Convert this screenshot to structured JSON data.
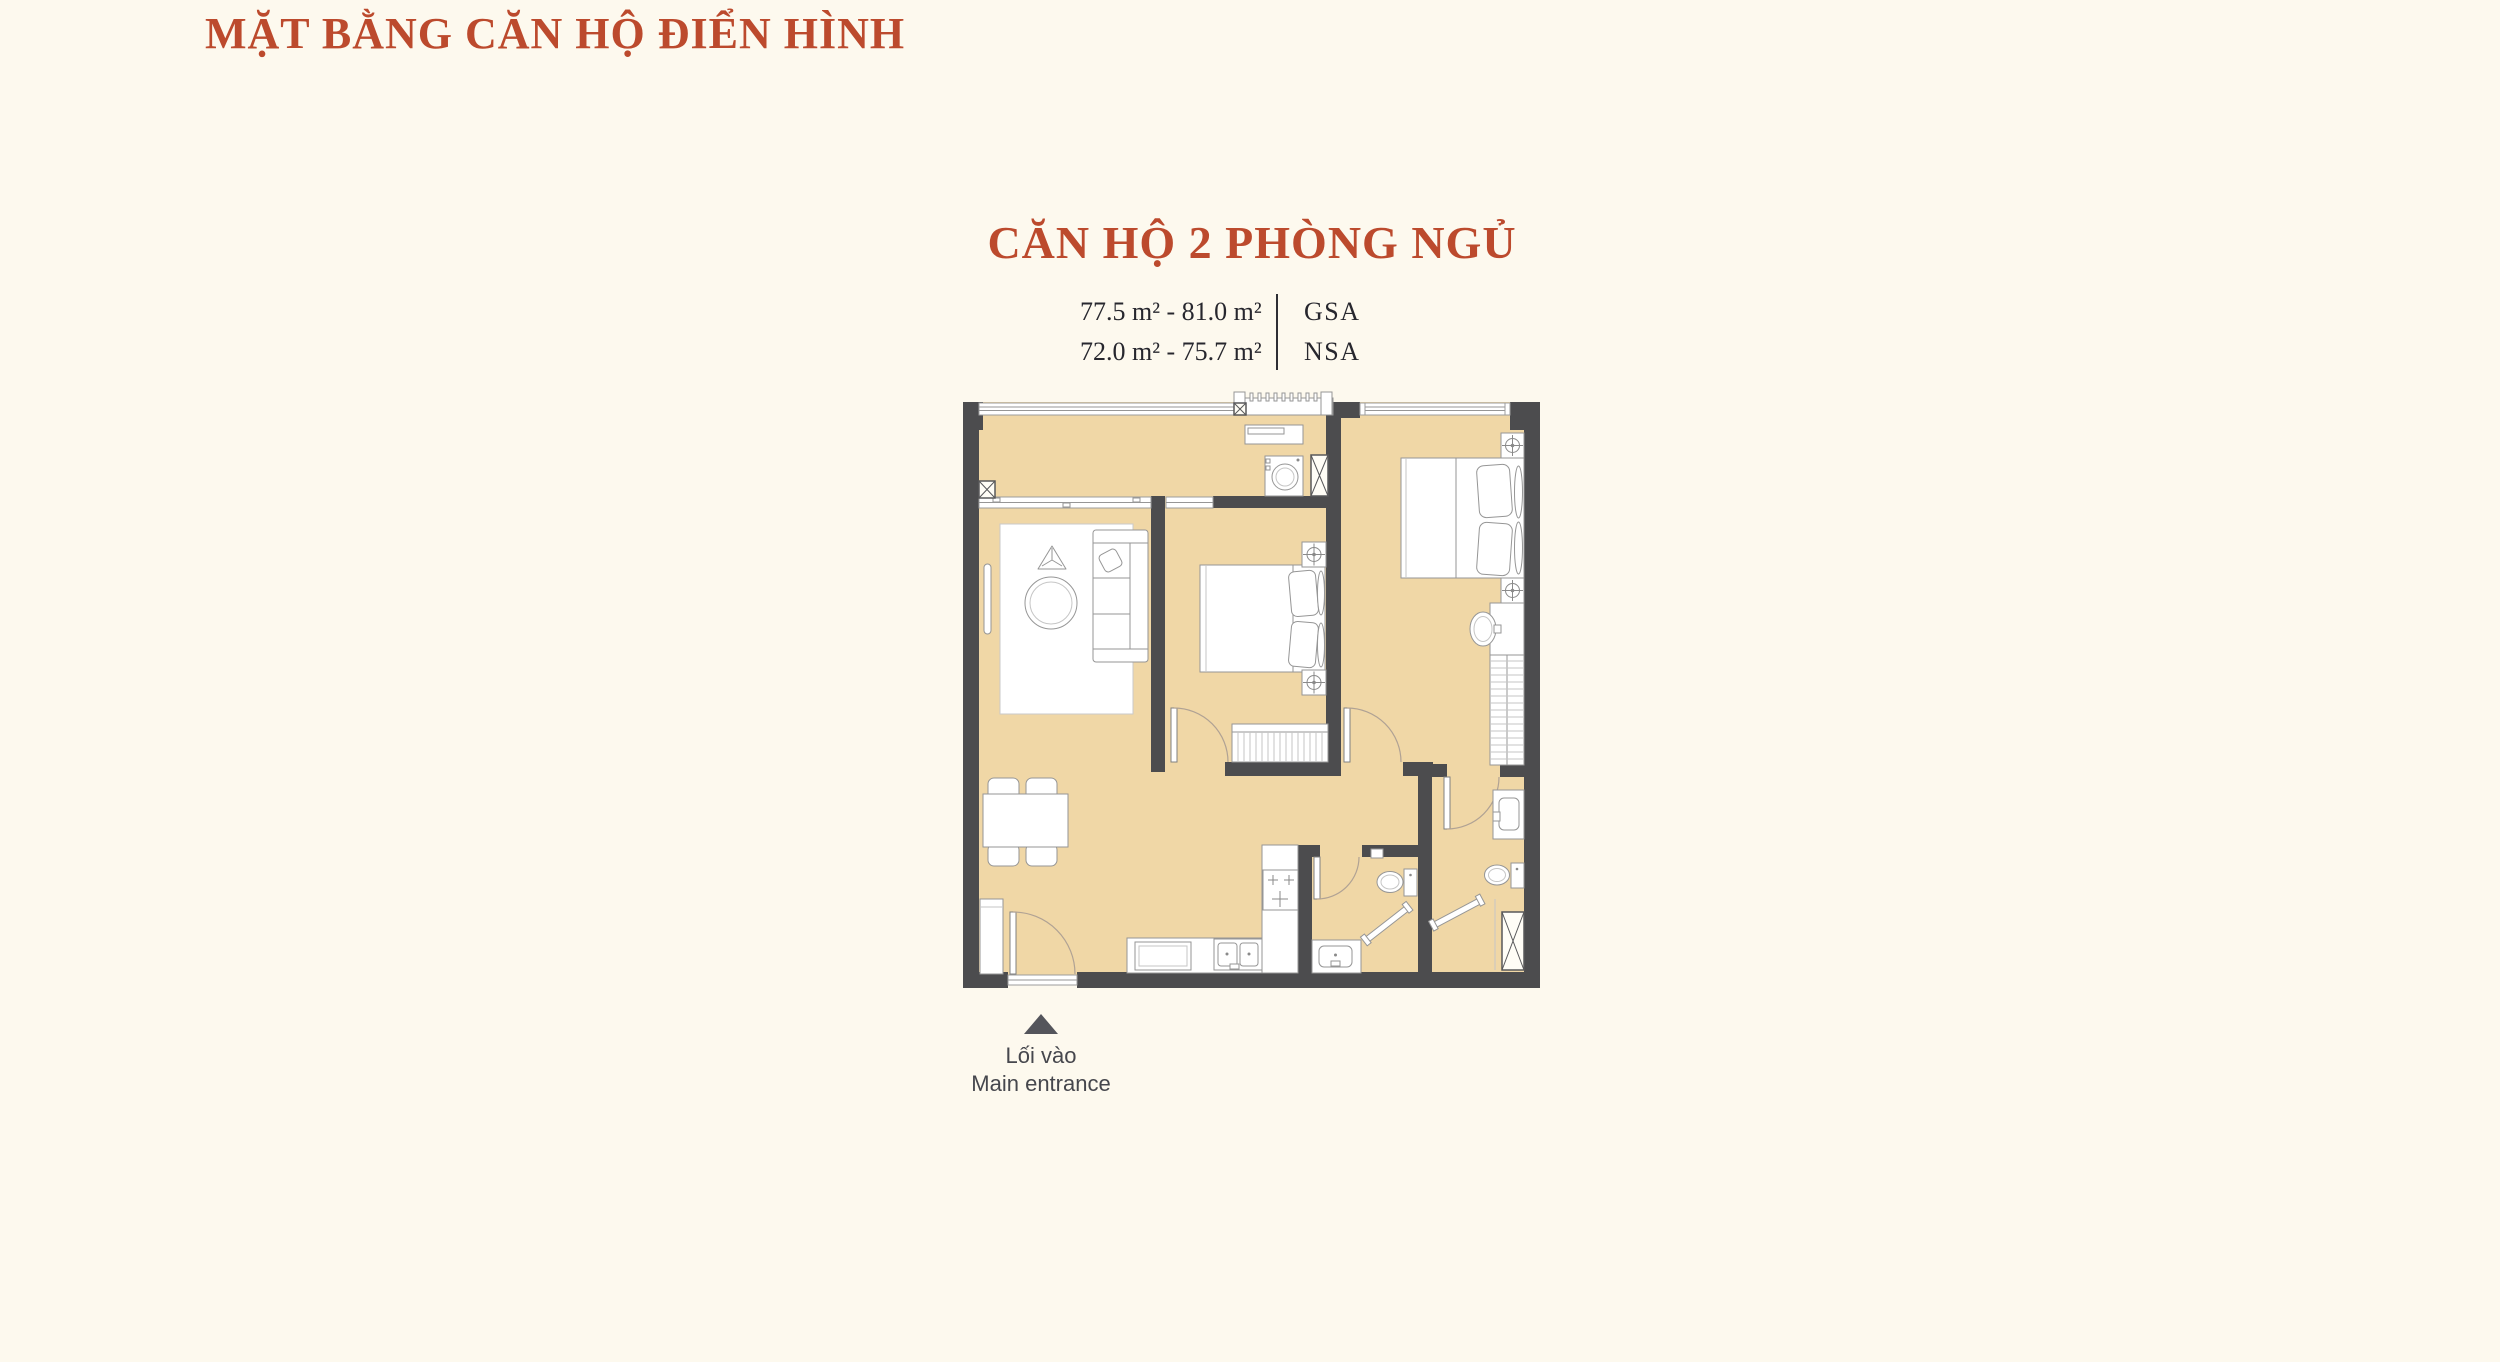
{
  "theme": {
    "background": "#FDF9EE",
    "accent": "#BC4A2D",
    "wall": "#4C4C4E",
    "floor": "#F0D7A6",
    "text-dark": "#27272E",
    "muted": "#54555B",
    "line": "#969696"
  },
  "header": {
    "title": "MẶT BẰNG CĂN HỘ ĐIỂN HÌNH"
  },
  "unit": {
    "name": "CĂN HỘ 2 PHÒNG NGỦ",
    "areas": [
      {
        "range": "77.5 m² - 81.0 m²",
        "label": "GSA"
      },
      {
        "range": "72.0 m² - 75.7 m²",
        "label": "NSA"
      }
    ]
  },
  "entrance": {
    "icon": "up-triangle-icon",
    "line1": "Lối vào",
    "line2": "Main entrance"
  },
  "floorplan": {
    "icons": [
      "bed-icon",
      "sofa-icon",
      "tv-icon",
      "coffee-table-icon",
      "side-table-icon",
      "dining-table-icon",
      "chair-icon",
      "entry-cabinet-icon",
      "wardrobe-icon",
      "washing-machine-icon",
      "console-table-icon",
      "stove-icon",
      "kitchen-sink-icon",
      "toilet-icon",
      "bathroom-sink-icon",
      "vanity-sink-icon",
      "shower-rail-icon",
      "ac-vent-icon",
      "shaft-x-icon",
      "door-swing-icon",
      "window-icon",
      "ac-ledge-icon"
    ]
  }
}
